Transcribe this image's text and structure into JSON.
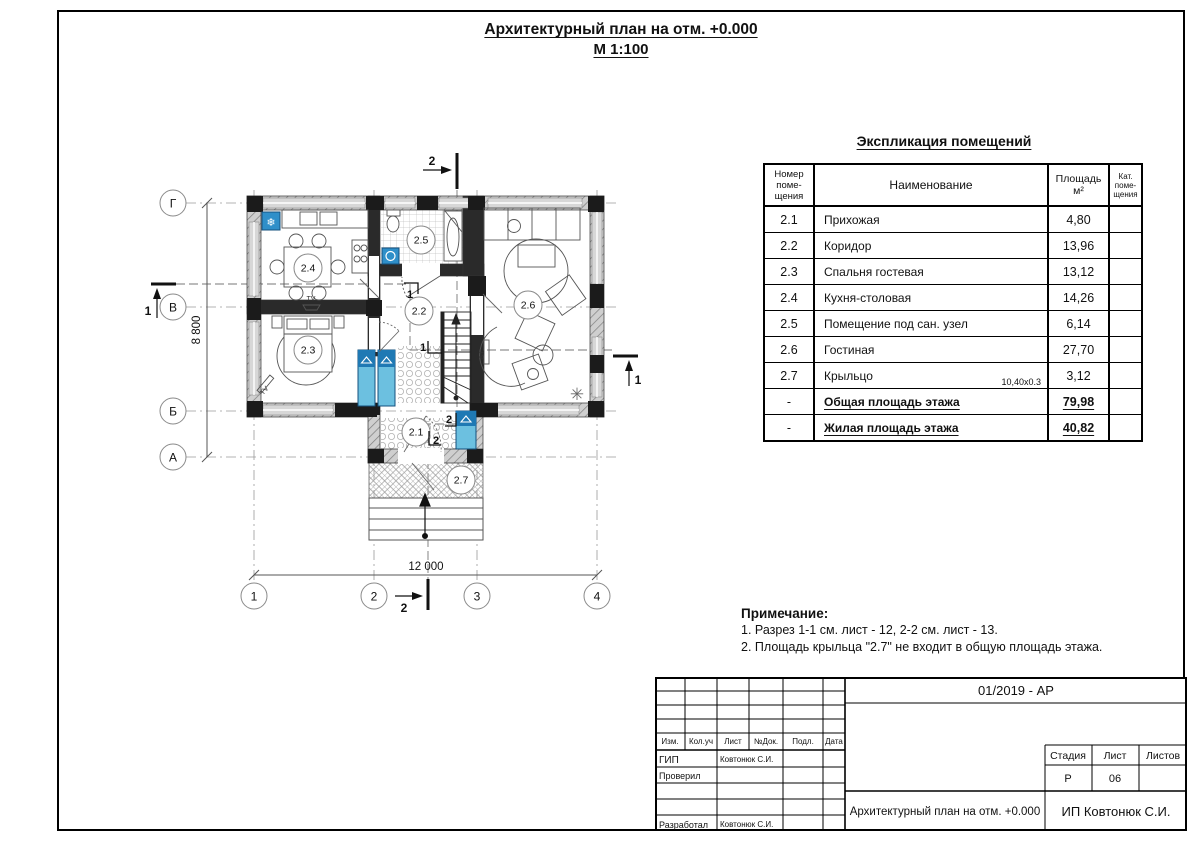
{
  "title": {
    "line1": "Архитектурный план на отм. +0.000",
    "line2": "М 1:100"
  },
  "explication": {
    "title": "Экспликация помещений",
    "col_num": "Номер\nпоме-\nщения",
    "col_name": "Наименование",
    "col_area": "Площадь\nм²",
    "col_cat": "Кат.\nпоме-\nщения",
    "rows": [
      {
        "num": "2.1",
        "name": "Прихожая",
        "area": "4,80",
        "cat": "",
        "sum": false
      },
      {
        "num": "2.2",
        "name": "Коридор",
        "area": "13,96",
        "cat": "",
        "sum": false
      },
      {
        "num": "2.3",
        "name": "Спальня гостевая",
        "area": "13,12",
        "cat": "",
        "sum": false
      },
      {
        "num": "2.4",
        "name": "Кухня-столовая",
        "area": "14,26",
        "cat": "",
        "sum": false
      },
      {
        "num": "2.5",
        "name": "Помещение под сан. узел",
        "area": "6,14",
        "cat": "",
        "sum": false
      },
      {
        "num": "2.6",
        "name": "Гостиная",
        "area": "27,70",
        "cat": "",
        "sum": false
      },
      {
        "num": "2.7",
        "name": "Крыльцо",
        "name_note": "10,40x0.3",
        "area": "3,12",
        "cat": "",
        "sum": false
      },
      {
        "num": "-",
        "name": "Общая площадь этажа",
        "area": "79,98",
        "cat": "",
        "sum": true
      },
      {
        "num": "-",
        "name": "Жилая площадь этажа",
        "area": "40,82",
        "cat": "",
        "sum": true
      }
    ]
  },
  "notes": {
    "title": "Примечание:",
    "items": [
      "1. Разрез 1-1 см. лист - 12, 2-2 см. лист - 13.",
      "2. Площадь крыльца \"2.7\" не входит в общую площадь этажа."
    ]
  },
  "plan": {
    "rooms": {
      "r21": "2.1",
      "r22": "2.2",
      "r23": "2.3",
      "r24": "2.4",
      "r25": "2.5",
      "r26": "2.6",
      "r27": "2.7"
    },
    "axes_left": [
      "Г",
      "В",
      "Б",
      "А"
    ],
    "axes_bottom": [
      "1",
      "2",
      "3",
      "4"
    ],
    "dim_width": "12 000",
    "dim_height": "8 800",
    "section1": "1",
    "section2": "2",
    "tv": "TV",
    "snowflake_icon": "❄",
    "plant_icon": "✳"
  },
  "titleblock": {
    "doc_number": "01/2019 - АР",
    "cols": [
      "Изм.",
      "Кол.уч",
      "Лист",
      "№Док.",
      "Подл.",
      "Дата"
    ],
    "roles": [
      {
        "label": "ГИП",
        "name": "Ковтонюк С.И."
      },
      {
        "label": "Проверил",
        "name": ""
      },
      {
        "label": "",
        "name": ""
      },
      {
        "label": "",
        "name": ""
      },
      {
        "label": "Разработал",
        "name": "Ковтонюк С.И."
      }
    ],
    "stage_label": "Стадия",
    "sheet_label": "Лист",
    "sheets_label": "Листов",
    "stage": "Р",
    "sheet": "06",
    "sheets": "",
    "drawing_title": "Архитектурный план на отм. +0.000",
    "company": "ИП Ковтонюк С.И."
  }
}
